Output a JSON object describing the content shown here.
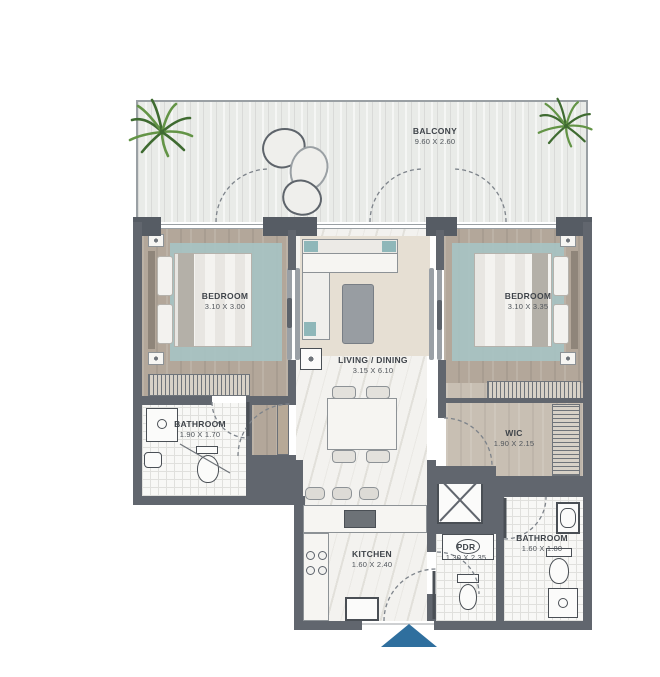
{
  "rooms": {
    "balcony": {
      "name": "BALCONY",
      "dims": "9.60 X 2.60"
    },
    "bedroom_left": {
      "name": "BEDROOM",
      "dims": "3.10 X 3.00"
    },
    "living_dining": {
      "name": "LIVING / DINING",
      "dims": "3.15 X 6.10"
    },
    "bedroom_right": {
      "name": "BEDROOM",
      "dims": "3.10 X 3.35"
    },
    "bathroom_left": {
      "name": "BATHROOM",
      "dims": "1.90 X 1.70"
    },
    "wic": {
      "name": "WIC",
      "dims": "1.90 X 2.15"
    },
    "kitchen": {
      "name": "KITCHEN",
      "dims": "1.60 X 2.40"
    },
    "pdr": {
      "name": "PDR",
      "dims": "1.30 X 2.35"
    },
    "bathroom_right": {
      "name": "BATHROOM",
      "dims": "1.60 X 1.80"
    }
  },
  "colors": {
    "wall": "#61666e",
    "floor_wood": "#b3a79a",
    "rug": "#a7c3c3",
    "balcony": "#e9ebe8",
    "entry_arrow": "#2f6f9e",
    "plant": "#639446"
  }
}
